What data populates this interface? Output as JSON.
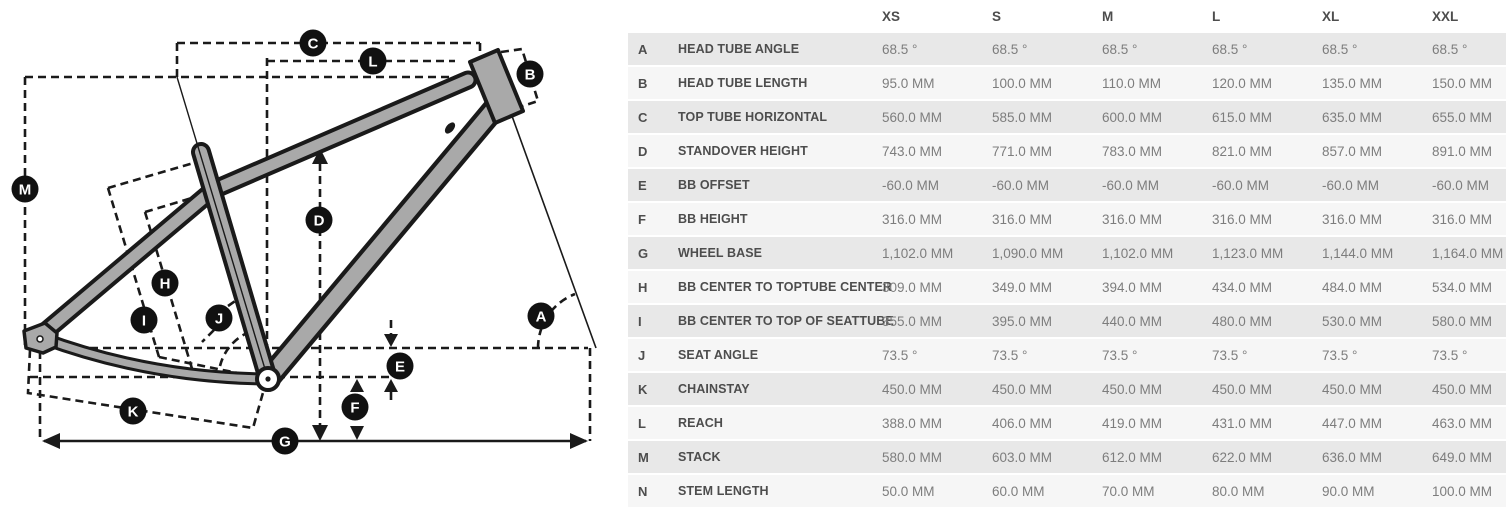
{
  "colors": {
    "frame_fill": "#a9a9a9",
    "line_color": "#1a1a1a",
    "label_circle_bg": "#111111",
    "label_letter_color": "#ffffff",
    "row_shade_dark": "#e8e8e8",
    "row_shade_light": "#f6f6f6",
    "header_text": "#4d4d4d",
    "value_text": "#7d7d7d"
  },
  "diagram": {
    "labels": [
      {
        "letter": "A",
        "x": 541,
        "y": 316
      },
      {
        "letter": "B",
        "x": 530,
        "y": 74
      },
      {
        "letter": "C",
        "x": 313,
        "y": 43
      },
      {
        "letter": "D",
        "x": 319,
        "y": 220
      },
      {
        "letter": "E",
        "x": 400,
        "y": 366
      },
      {
        "letter": "F",
        "x": 355,
        "y": 407
      },
      {
        "letter": "G",
        "x": 285,
        "y": 441
      },
      {
        "letter": "H",
        "x": 165,
        "y": 283
      },
      {
        "letter": "I",
        "x": 144,
        "y": 320
      },
      {
        "letter": "J",
        "x": 219,
        "y": 318
      },
      {
        "letter": "K",
        "x": 133,
        "y": 411
      },
      {
        "letter": "L",
        "x": 373,
        "y": 61
      },
      {
        "letter": "M",
        "x": 25,
        "y": 189
      }
    ]
  },
  "table": {
    "columns": [
      "XS",
      "S",
      "M",
      "L",
      "XL",
      "XXL"
    ],
    "rows": [
      {
        "letter": "A",
        "name": "HEAD TUBE ANGLE",
        "values": [
          "68.5 °",
          "68.5 °",
          "68.5 °",
          "68.5 °",
          "68.5 °",
          "68.5 °"
        ]
      },
      {
        "letter": "B",
        "name": "HEAD TUBE LENGTH",
        "values": [
          "95.0 MM",
          "100.0 MM",
          "110.0 MM",
          "120.0 MM",
          "135.0 MM",
          "150.0 MM"
        ]
      },
      {
        "letter": "C",
        "name": "TOP TUBE HORIZONTAL",
        "values": [
          "560.0 MM",
          "585.0 MM",
          "600.0 MM",
          "615.0 MM",
          "635.0 MM",
          "655.0 MM"
        ]
      },
      {
        "letter": "D",
        "name": "STANDOVER HEIGHT",
        "values": [
          "743.0 MM",
          "771.0 MM",
          "783.0 MM",
          "821.0 MM",
          "857.0 MM",
          "891.0 MM"
        ]
      },
      {
        "letter": "E",
        "name": "BB OFFSET",
        "values": [
          "-60.0 MM",
          "-60.0 MM",
          "-60.0 MM",
          "-60.0 MM",
          "-60.0 MM",
          "-60.0 MM"
        ]
      },
      {
        "letter": "F",
        "name": "BB HEIGHT",
        "values": [
          "316.0 MM",
          "316.0 MM",
          "316.0 MM",
          "316.0 MM",
          "316.0 MM",
          "316.0 MM"
        ]
      },
      {
        "letter": "G",
        "name": "WHEEL BASE",
        "values": [
          "1,102.0 MM",
          "1,090.0 MM",
          "1,102.0 MM",
          "1,123.0 MM",
          "1,144.0 MM",
          "1,164.0 MM"
        ]
      },
      {
        "letter": "H",
        "name": "BB CENTER TO TOPTUBE CENTER",
        "values": [
          "309.0 MM",
          "349.0 MM",
          "394.0 MM",
          "434.0 MM",
          "484.0 MM",
          "534.0 MM"
        ]
      },
      {
        "letter": "I",
        "name": "BB CENTER TO TOP OF SEATTUBE",
        "values": [
          "355.0 MM",
          "395.0 MM",
          "440.0 MM",
          "480.0 MM",
          "530.0 MM",
          "580.0 MM"
        ]
      },
      {
        "letter": "J",
        "name": "SEAT ANGLE",
        "values": [
          "73.5 °",
          "73.5 °",
          "73.5 °",
          "73.5 °",
          "73.5 °",
          "73.5 °"
        ]
      },
      {
        "letter": "K",
        "name": "CHAINSTAY",
        "values": [
          "450.0 MM",
          "450.0 MM",
          "450.0 MM",
          "450.0 MM",
          "450.0 MM",
          "450.0 MM"
        ]
      },
      {
        "letter": "L",
        "name": "REACH",
        "values": [
          "388.0 MM",
          "406.0 MM",
          "419.0 MM",
          "431.0 MM",
          "447.0 MM",
          "463.0 MM"
        ]
      },
      {
        "letter": "M",
        "name": "STACK",
        "values": [
          "580.0 MM",
          "603.0 MM",
          "612.0 MM",
          "622.0 MM",
          "636.0 MM",
          "649.0 MM"
        ]
      },
      {
        "letter": "N",
        "name": "STEM LENGTH",
        "values": [
          "50.0 MM",
          "60.0 MM",
          "70.0 MM",
          "80.0 MM",
          "90.0 MM",
          "100.0 MM"
        ]
      }
    ]
  }
}
